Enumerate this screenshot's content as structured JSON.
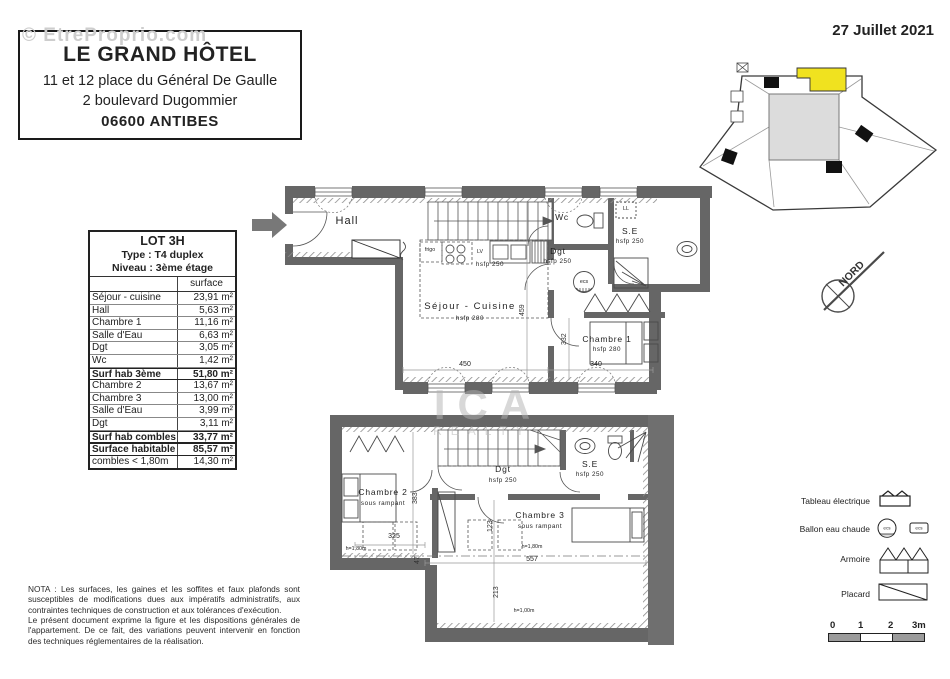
{
  "colors": {
    "accent_yellow": "#f0e21f",
    "wall_gray": "#666666",
    "keyplan_fill": "#dcdcdc"
  },
  "watermarks": {
    "top_left": "© EtreProprio.com",
    "center_line1": "ICA",
    "center_line2": "REALTY"
  },
  "header": {
    "date": "27 Juillet 2021"
  },
  "title_block": {
    "name": "LE GRAND HÔTEL",
    "address1": "11 et 12 place du Général De Gaulle",
    "address2": "2 boulevard Dugommier",
    "city": "06600 ANTIBES"
  },
  "lot_table": {
    "title": "LOT 3H",
    "type_line": "Type : T4 duplex",
    "level_line": "Niveau : 3ème étage",
    "surface_header": "surface",
    "rows": [
      {
        "label": "Séjour - cuisine",
        "value": "23,91 m²"
      },
      {
        "label": "Hall",
        "value": "5,63 m²"
      },
      {
        "label": "Chambre 1",
        "value": "11,16 m²"
      },
      {
        "label": "Salle d'Eau",
        "value": "6,63 m²"
      },
      {
        "label": "Dgt",
        "value": "3,05 m²"
      },
      {
        "label": "Wc",
        "value": "1,42 m²"
      },
      {
        "label": "Surf hab 3ème",
        "value": "51,80 m²"
      },
      {
        "label": "Chambre 2",
        "value": "13,67 m²"
      },
      {
        "label": "Chambre 3",
        "value": "13,00 m²"
      },
      {
        "label": "Salle d'Eau",
        "value": "3,99 m²"
      },
      {
        "label": "Dgt",
        "value": "3,11 m²"
      },
      {
        "label": "Surf hab combles",
        "value": "33,77 m²"
      },
      {
        "label": "Surface habitable",
        "value": "85,57 m²"
      },
      {
        "label": "combles < 1,80m",
        "value": "14,30 m²"
      }
    ]
  },
  "compass": {
    "label": "NORD"
  },
  "plan_upper": {
    "hall": "Hall",
    "sejour": "Séjour - Cuisine",
    "sejour_h": "hsfp 280",
    "kitchen_h": "hsfp 250",
    "frigo": "frigo",
    "lv": "LV",
    "ll": "LL",
    "wc": "Wc",
    "dgt": "Dgt",
    "dgt_h": "hsfp 250",
    "se": "S.E",
    "se_h": "hsfp 250",
    "ecs": "ecs",
    "chambre1": "Chambre 1",
    "chambre1_h": "hsfp 280",
    "dim_width": "450",
    "dim_ch1": "340",
    "dim_height": "459",
    "dim_ch1_v": "332"
  },
  "plan_lower": {
    "chambre2": "Chambre 2",
    "chambre2_sub": "sous rampant",
    "chambre3": "Chambre 3",
    "chambre3_sub": "sous rampant",
    "dgt": "Dgt",
    "dgt_h": "hsfp 250",
    "se": "S.E",
    "se_h": "hsfp 250",
    "dim_ch2": "325",
    "dim_width": "557",
    "dim_v1": "383",
    "dim_v2": "47",
    "dim_v3": "123",
    "dim_v4": "213",
    "h180_left": "h=1,80m",
    "h180_mid": "h=1,80m",
    "h100": "h=1,00m"
  },
  "legend": {
    "items": [
      {
        "label": "Tableau électrique"
      },
      {
        "label": "Ballon eau chaude"
      },
      {
        "label": "Armoire"
      },
      {
        "label": "Placard"
      }
    ],
    "ecs_small": "ecs"
  },
  "scale_bar": {
    "labels": [
      "0",
      "1",
      "2",
      "3m"
    ]
  },
  "nota": {
    "para1": "NOTA : Les surfaces, les gaines et les soffites et faux plafonds sont susceptibles de modifications dues aux impératifs administratifs, aux contraintes techniques de construction et aux tolérances d'exécution.",
    "para2": "Le présent document exprime la figure et les dispositions générales de l'appartement. De ce fait, des variations peuvent intervenir en fonction des techniques réglementaires de la réalisation."
  }
}
